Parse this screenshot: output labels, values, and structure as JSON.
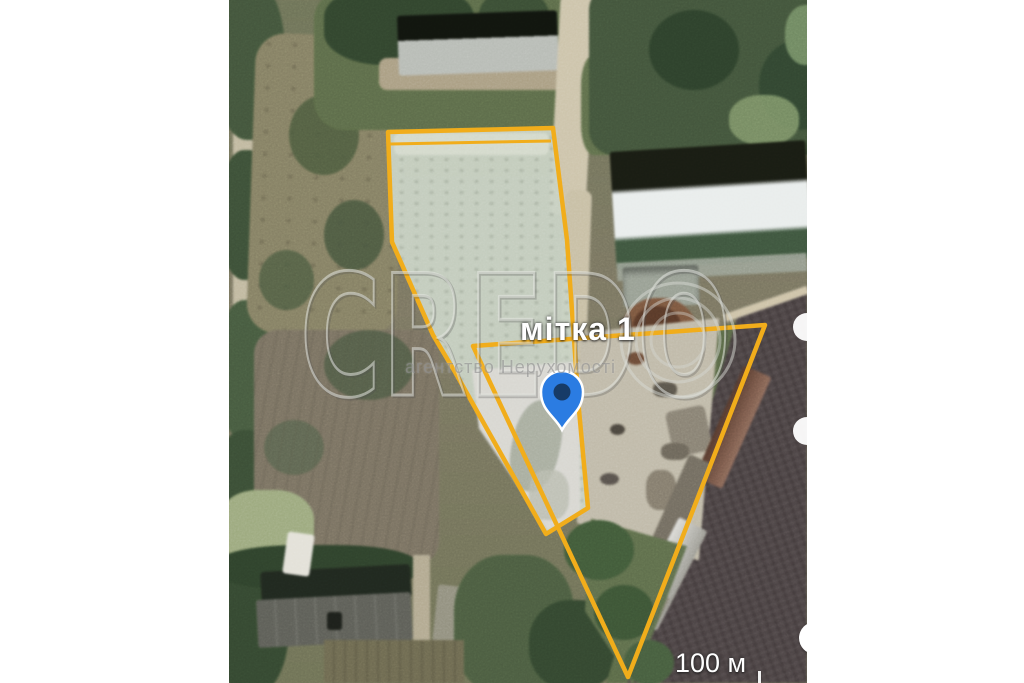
{
  "map": {
    "marker": {
      "label": "мітка 1"
    },
    "scale": {
      "label": "100 м"
    },
    "watermark": {
      "brand": "CREDO",
      "agency": "агентство Нерухомості"
    },
    "colors": {
      "parcel_outline": "#f1ad1b",
      "marker_fill": "#2b7ce2",
      "marker_dot": "#16355c",
      "parcel_fill": "#c8d1c1",
      "plowed_field": "#4d4445"
    }
  }
}
